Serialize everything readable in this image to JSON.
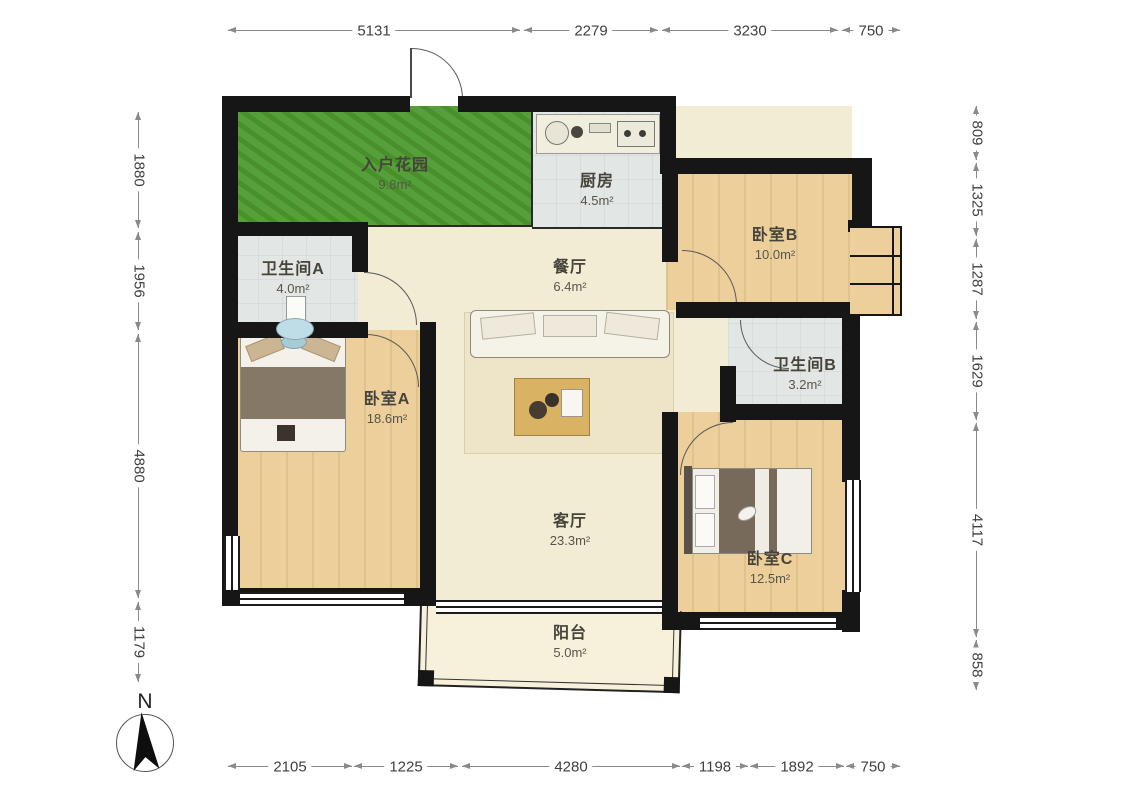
{
  "rooms": {
    "garden": {
      "name": "入户花园",
      "area": "9.8m²"
    },
    "kitchen": {
      "name": "厨房",
      "area": "4.5m²"
    },
    "bedroom_b": {
      "name": "卧室B",
      "area": "10.0m²"
    },
    "bath_a": {
      "name": "卫生间A",
      "area": "4.0m²"
    },
    "dining": {
      "name": "餐厅",
      "area": "6.4m²"
    },
    "bath_b": {
      "name": "卫生间B",
      "area": "3.2m²"
    },
    "bedroom_a": {
      "name": "卧室A",
      "area": "18.6m²"
    },
    "living": {
      "name": "客厅",
      "area": "23.3m²"
    },
    "bedroom_c": {
      "name": "卧室C",
      "area": "12.5m²"
    },
    "balcony": {
      "name": "阳台",
      "area": "5.0m²"
    }
  },
  "dimensions": {
    "top": [
      "5131",
      "2279",
      "3230",
      "750"
    ],
    "bottom": [
      "2105",
      "1225",
      "4280",
      "1198",
      "1892",
      "750"
    ],
    "left": [
      "1880",
      "1956",
      "4880",
      "1179"
    ],
    "right": [
      "809",
      "1325",
      "1287",
      "1629",
      "4117",
      "858"
    ]
  },
  "compass": {
    "label": "N"
  },
  "colors": {
    "garden_green": "#4f9c31",
    "wood_floor": "#eccf9b",
    "tile_gray": "#e2e6e4",
    "cream_floor": "#f3ecd4",
    "balcony_floor": "#f7f1dc",
    "wall_black": "#161616"
  }
}
